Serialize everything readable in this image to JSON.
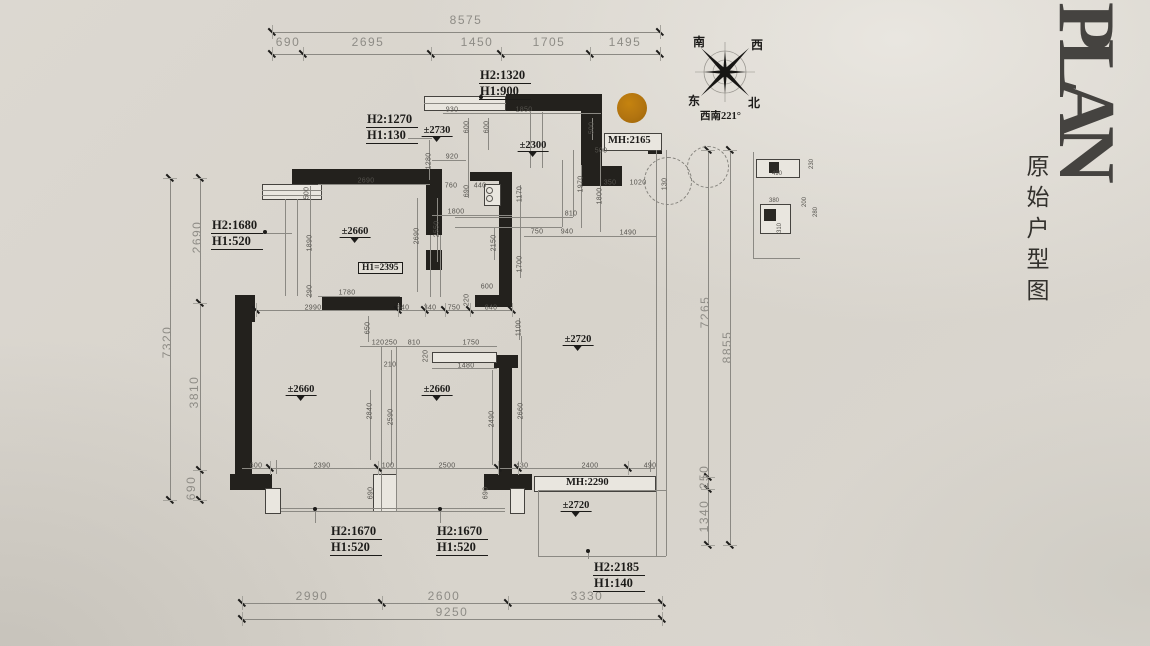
{
  "header": {
    "title_en": "PLAN",
    "title_cn": "原始户型图"
  },
  "compass": {
    "n1": "南",
    "n2": "西",
    "n3": "东",
    "n4": "北",
    "caption": "西南221°"
  },
  "colors": {
    "wall": "#23211d",
    "dimension_gray": "#8e8c86",
    "dimension_dark": "#54524d",
    "accent_circle": "#b27410",
    "label_ink": "#1c1b19",
    "paper": "#d7d3cb"
  },
  "outer_dims": [
    {
      "t": "8575",
      "x": 466,
      "y": 20
    },
    {
      "t": "690",
      "x": 288,
      "y": 42
    },
    {
      "t": "2695",
      "x": 368,
      "y": 42
    },
    {
      "t": "1450",
      "x": 477,
      "y": 42
    },
    {
      "t": "1705",
      "x": 549,
      "y": 42
    },
    {
      "t": "1495",
      "x": 625,
      "y": 42
    },
    {
      "t": "2690",
      "x": 197,
      "y": 237,
      "v": 1
    },
    {
      "t": "3810",
      "x": 194,
      "y": 392,
      "v": 1
    },
    {
      "t": "690",
      "x": 191,
      "y": 488,
      "v": 1
    },
    {
      "t": "7320",
      "x": 167,
      "y": 342,
      "v": 1
    },
    {
      "t": "7265",
      "x": 705,
      "y": 312,
      "v": 1
    },
    {
      "t": "8855",
      "x": 727,
      "y": 347,
      "v": 1
    },
    {
      "t": "250",
      "x": 704,
      "y": 477,
      "v": 1
    },
    {
      "t": "1340",
      "x": 704,
      "y": 516,
      "v": 1
    },
    {
      "t": "2990",
      "x": 312,
      "y": 596
    },
    {
      "t": "2600",
      "x": 444,
      "y": 596
    },
    {
      "t": "3330",
      "x": 587,
      "y": 596
    },
    {
      "t": "9250",
      "x": 452,
      "y": 612
    }
  ],
  "inner_dims": [
    {
      "t": "930",
      "x": 452,
      "y": 110
    },
    {
      "t": "1850",
      "x": 524,
      "y": 110
    },
    {
      "t": "600",
      "x": 467,
      "y": 127,
      "v": 1
    },
    {
      "t": "600",
      "x": 487,
      "y": 127,
      "v": 1
    },
    {
      "t": "500",
      "x": 592,
      "y": 128,
      "v": 1
    },
    {
      "t": "1280",
      "x": 429,
      "y": 161,
      "v": 1
    },
    {
      "t": "920",
      "x": 452,
      "y": 157
    },
    {
      "t": "500",
      "x": 601,
      "y": 151
    },
    {
      "t": "350",
      "x": 610,
      "y": 183
    },
    {
      "t": "1020",
      "x": 638,
      "y": 183
    },
    {
      "t": "130",
      "x": 665,
      "y": 184,
      "v": 1
    },
    {
      "t": "690",
      "x": 467,
      "y": 191,
      "v": 1
    },
    {
      "t": "2690",
      "x": 366,
      "y": 181
    },
    {
      "t": "760",
      "x": 451,
      "y": 186
    },
    {
      "t": "440",
      "x": 480,
      "y": 186
    },
    {
      "t": "500",
      "x": 307,
      "y": 193,
      "v": 1
    },
    {
      "t": "1970",
      "x": 581,
      "y": 184,
      "v": 1
    },
    {
      "t": "1800",
      "x": 600,
      "y": 196,
      "v": 1
    },
    {
      "t": "1800",
      "x": 456,
      "y": 212
    },
    {
      "t": "810",
      "x": 571,
      "y": 214
    },
    {
      "t": "1890",
      "x": 310,
      "y": 243,
      "v": 1
    },
    {
      "t": "2690",
      "x": 417,
      "y": 236,
      "v": 1
    },
    {
      "t": "2550",
      "x": 437,
      "y": 229,
      "v": 1
    },
    {
      "t": "1170",
      "x": 520,
      "y": 194,
      "v": 1
    },
    {
      "t": "2150",
      "x": 494,
      "y": 243,
      "v": 1
    },
    {
      "t": "750",
      "x": 537,
      "y": 232
    },
    {
      "t": "940",
      "x": 567,
      "y": 232
    },
    {
      "t": "1490",
      "x": 628,
      "y": 233
    },
    {
      "t": "1700",
      "x": 520,
      "y": 264,
      "v": 1
    },
    {
      "t": "290",
      "x": 310,
      "y": 291,
      "v": 1
    },
    {
      "t": "1780",
      "x": 347,
      "y": 293
    },
    {
      "t": "600",
      "x": 487,
      "y": 287
    },
    {
      "t": "220",
      "x": 467,
      "y": 300,
      "v": 1
    },
    {
      "t": "2990",
      "x": 313,
      "y": 308
    },
    {
      "t": "840",
      "x": 403,
      "y": 308
    },
    {
      "t": "340",
      "x": 430,
      "y": 308
    },
    {
      "t": "750",
      "x": 454,
      "y": 308
    },
    {
      "t": "840",
      "x": 491,
      "y": 308
    },
    {
      "t": "650",
      "x": 368,
      "y": 328,
      "v": 1
    },
    {
      "t": "1100",
      "x": 519,
      "y": 328,
      "v": 1
    },
    {
      "t": "120",
      "x": 378,
      "y": 343
    },
    {
      "t": "250",
      "x": 391,
      "y": 343
    },
    {
      "t": "810",
      "x": 414,
      "y": 343
    },
    {
      "t": "1750",
      "x": 471,
      "y": 343
    },
    {
      "t": "210",
      "x": 390,
      "y": 365
    },
    {
      "t": "1480",
      "x": 466,
      "y": 366
    },
    {
      "t": "220",
      "x": 426,
      "y": 356,
      "v": 1
    },
    {
      "t": "2840",
      "x": 370,
      "y": 411,
      "v": 1
    },
    {
      "t": "2590",
      "x": 391,
      "y": 417,
      "v": 1
    },
    {
      "t": "2490",
      "x": 492,
      "y": 419,
      "v": 1
    },
    {
      "t": "2660",
      "x": 521,
      "y": 411,
      "v": 1
    },
    {
      "t": "600",
      "x": 256,
      "y": 466
    },
    {
      "t": "2390",
      "x": 322,
      "y": 466
    },
    {
      "t": "100",
      "x": 388,
      "y": 466
    },
    {
      "t": "2500",
      "x": 447,
      "y": 466
    },
    {
      "t": "430",
      "x": 522,
      "y": 466
    },
    {
      "t": "2400",
      "x": 590,
      "y": 466
    },
    {
      "t": "490",
      "x": 650,
      "y": 466
    },
    {
      "t": "690",
      "x": 371,
      "y": 493,
      "v": 1
    },
    {
      "t": "690",
      "x": 486,
      "y": 493,
      "v": 1
    }
  ],
  "detail_dims": [
    {
      "t": "490",
      "x": 777,
      "y": 174
    },
    {
      "t": "230",
      "x": 812,
      "y": 164,
      "v": 1
    },
    {
      "t": "380",
      "x": 774,
      "y": 201
    },
    {
      "t": "200",
      "x": 805,
      "y": 202,
      "v": 1
    },
    {
      "t": "280",
      "x": 816,
      "y": 212,
      "v": 1
    },
    {
      "t": "310",
      "x": 780,
      "y": 228,
      "v": 1
    }
  ],
  "levels": [
    {
      "t": "±2730",
      "x": 437,
      "y": 131
    },
    {
      "t": "±2300",
      "x": 533,
      "y": 146
    },
    {
      "t": "±2660",
      "x": 355,
      "y": 232
    },
    {
      "t": "±2660",
      "x": 301,
      "y": 390
    },
    {
      "t": "±2660",
      "x": 437,
      "y": 390
    },
    {
      "t": "±2720",
      "x": 578,
      "y": 340
    },
    {
      "t": "±2720",
      "x": 576,
      "y": 506
    }
  ],
  "height_labels": [
    {
      "l1": "H2:1320",
      "l2": "H1:900",
      "x": 479,
      "y": 68
    },
    {
      "l1": "H2:1270",
      "l2": "H1:130",
      "x": 366,
      "y": 112
    },
    {
      "l1": "H2:1680",
      "l2": "H1:520",
      "x": 211,
      "y": 218
    },
    {
      "l1": "H2:1670",
      "l2": "H1:520",
      "x": 330,
      "y": 524
    },
    {
      "l1": "H2:1670",
      "l2": "H1:520",
      "x": 436,
      "y": 524
    },
    {
      "l1": "H2:2185",
      "l2": "H1:140",
      "x": 593,
      "y": 560
    }
  ],
  "mh_labels": [
    {
      "t": "MH:2165",
      "x": 608,
      "y": 135
    },
    {
      "t": "MH:2290",
      "x": 566,
      "y": 477
    }
  ],
  "boxed_labels": [
    {
      "t": "H1=2395",
      "x": 358,
      "y": 262
    }
  ]
}
